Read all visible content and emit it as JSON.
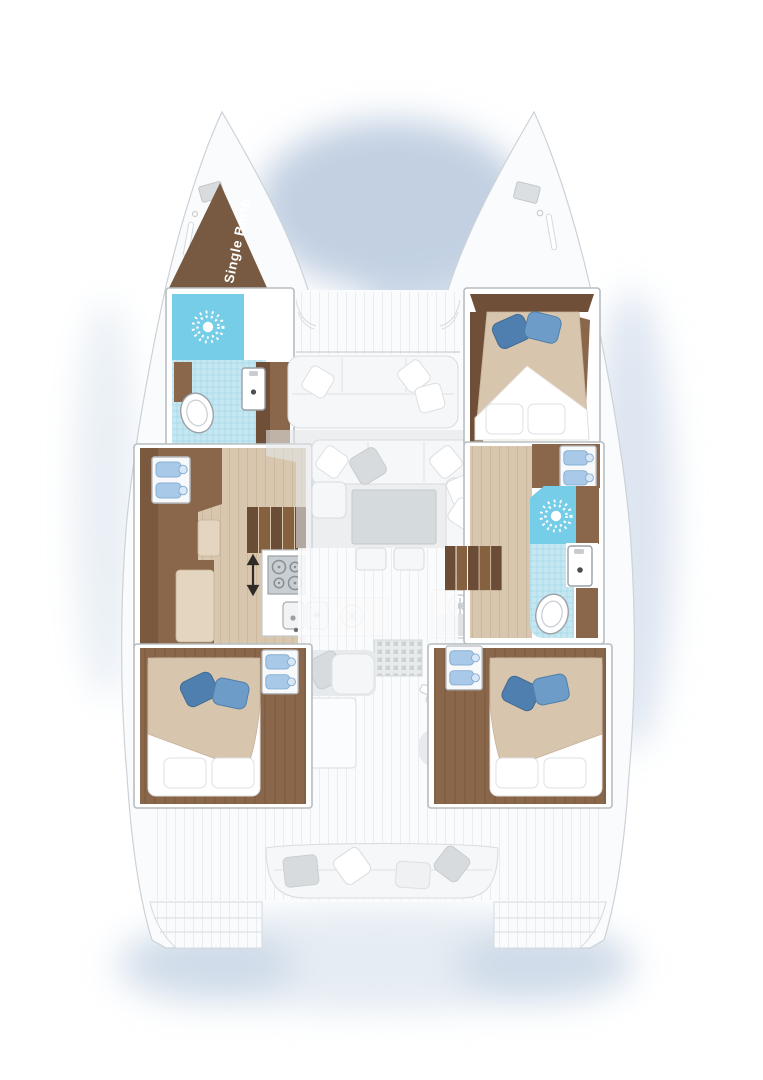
{
  "page": {
    "type": "catamaran-yacht-floor-plan",
    "background": "#ffffff"
  },
  "labels": {
    "single_berth": "Single Berth"
  },
  "colors": {
    "bg": "#ffffff",
    "shadow-blue": "#b7c8dd",
    "shadow-blue-light": "#d2deec",
    "hull": "#fafbfc",
    "hull-stroke": "#ccd2d7",
    "wall-stroke": "#b7bdc2",
    "plank-line": "#e9edef",
    "wood-dark": "#6f4f37",
    "wood-mid": "#8a664a",
    "floor-beige": "#d8c6ae",
    "floor-line": "#c6b296",
    "cushion": "#e3d5bf",
    "berth-brown": "#775a41",
    "mattress": "#d8c5ad",
    "pillow-blue": "#6d9cc9",
    "pillow-blue-2": "#4e7fae",
    "shower-blue": "#76cde8",
    "tile-blue": "#c5e7f2",
    "tile-line": "#a4d8e8",
    "basin-blue": "#a9c9e8",
    "salon-shadow": "#e1e5e7",
    "table-gray": "#d5dadc",
    "gray-pillow": "#d7dbde",
    "stove-gray": "#c9ced2",
    "fixture-stroke": "#9aa1a7",
    "counter-stroke": "#c5cacf",
    "arrow-dark": "#2f2b27",
    "icon-gray": "#c6cbcf"
  },
  "fixtures": {
    "single_berths": 1,
    "double_beds": 3,
    "shower_sun_icons": 2,
    "toilets": 2,
    "bathroom_sinks": 2,
    "double_washbasin_units": 4,
    "galley_stove_burners": 4,
    "galley_sinks": 2,
    "round_vent_icons": 2,
    "staircases": 2,
    "passage_arrow": "up-down",
    "salon_table": 1,
    "cockpit_bench": 1,
    "swim_platforms": 2
  }
}
